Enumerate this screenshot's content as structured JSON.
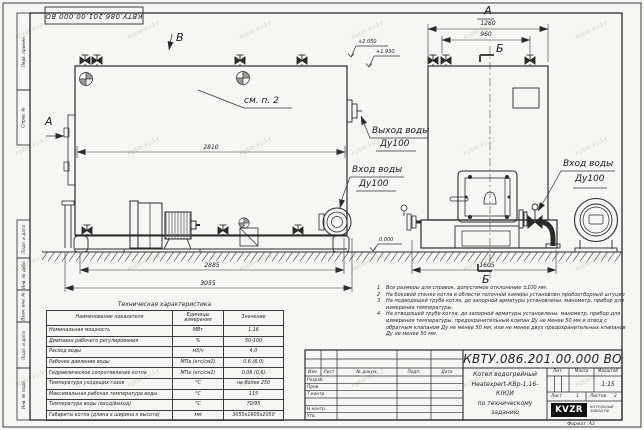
{
  "watermark": "kotel-kv.kz",
  "doc": {
    "designation": "КВТУ.086.201.00.000  ВО"
  },
  "sidebar": [
    "Перв. примен.",
    "Справ. №",
    "Подп. и дата",
    "Инв. № дубл.",
    "Взам. инв. №",
    "Подп. и дата",
    "Инв. № подл."
  ],
  "drawing": {
    "view_b": "В",
    "view_a_marker": "А",
    "see_note": "см. п. 2",
    "front_label": "А",
    "section_top": "Б",
    "section_bottom": "Б",
    "dim_2810": "2810",
    "dim_2885": "2885",
    "dim_3055": "3055",
    "dim_1260": "1260",
    "dim_960": "960",
    "dim_1605": "1605",
    "elev_top": "+2.050",
    "elev_outlet": "+1.930",
    "elev_zero": "0.000",
    "outlet_l1": "Выход воды",
    "outlet_l2": "Ду100",
    "inlet_side_l1": "Вход воды",
    "inlet_side_l2": "Ду100",
    "inlet_front_l1": "Вход воды",
    "inlet_front_l2": "Ду100"
  },
  "notes": {
    "items": [
      {
        "n": "1",
        "t": "Все размеры для справок, допустимое отклонение  ±100 мм."
      },
      {
        "n": "2",
        "t": "На боковой стенке котла в области топочной камеры установлен пробоотборный штуцер"
      },
      {
        "n": "3",
        "t": "На  подводящей трубе котла, до запорной арматуры установлены: манометр, прибор для измерения температуры."
      },
      {
        "n": "4",
        "t": "На отводящей трубе котла, до запорной арматуры установлены: манометр, прибор для измерения температуры, предохранительный клапан  Ду не менее  50 мм и отвод с обратным клапаном  Ду не менее  50 мм, или не менее двух предохранительных клапанов  Ду не менее  50 мм."
      }
    ]
  },
  "tech_table": {
    "title": "Техническая характеристика",
    "headers": [
      "Наименование показателя",
      "Единицы измерения",
      "Значение"
    ],
    "rows": [
      [
        "Номинальная мощность",
        "МВт",
        "1,16"
      ],
      [
        "Диапазон рабочего регулирования",
        "%",
        "50-100"
      ],
      [
        "Расход воды",
        "м3/ч",
        "4,0"
      ],
      [
        "Рабочее давление воды",
        "МПа (кгс/см2)",
        "0,6 (6,0)"
      ],
      [
        "Гидравлическое сопротивление котла",
        "МПа (кгс/см2)",
        "0,06 (0,6)"
      ],
      [
        "Температура уходящих газов",
        "°С",
        "не более 250"
      ],
      [
        "Максимальная рабочая температура воды",
        "°С",
        "115"
      ],
      [
        "Температура воды (вход/выход)",
        "°С",
        "70/95"
      ],
      [
        "Габариты котла (длина х ширина х высота)",
        "мм",
        "3055х1605х2050"
      ]
    ]
  },
  "title_block": {
    "name_line1": "Котел водогрейный",
    "name_line2": "Heatexpert-КВр-1,16-К(К)И",
    "name_line3": "по техническому заданию",
    "lit_label": "Лит.",
    "mass_label": "Масса",
    "scale_label": "Масштаб",
    "scale_value": "1:15",
    "sheet_label": "Лист",
    "sheet_value": "1",
    "sheets_label": "Листов",
    "sheets_value": "2",
    "staff_header": [
      "Изм.",
      "Лист",
      "№ докум.",
      "Подп.",
      "Дата"
    ],
    "staff_rows": [
      "Разраб.",
      "Пров.",
      "Т.контр.",
      "",
      "Н.контр.",
      "Утв."
    ],
    "logo_text": "KVZR",
    "logo_cap1": "КОТЕЛЬНЫЙ",
    "logo_cap2": "ЗАВОД РФ",
    "format_label": "Формат",
    "format_value": "А3"
  }
}
